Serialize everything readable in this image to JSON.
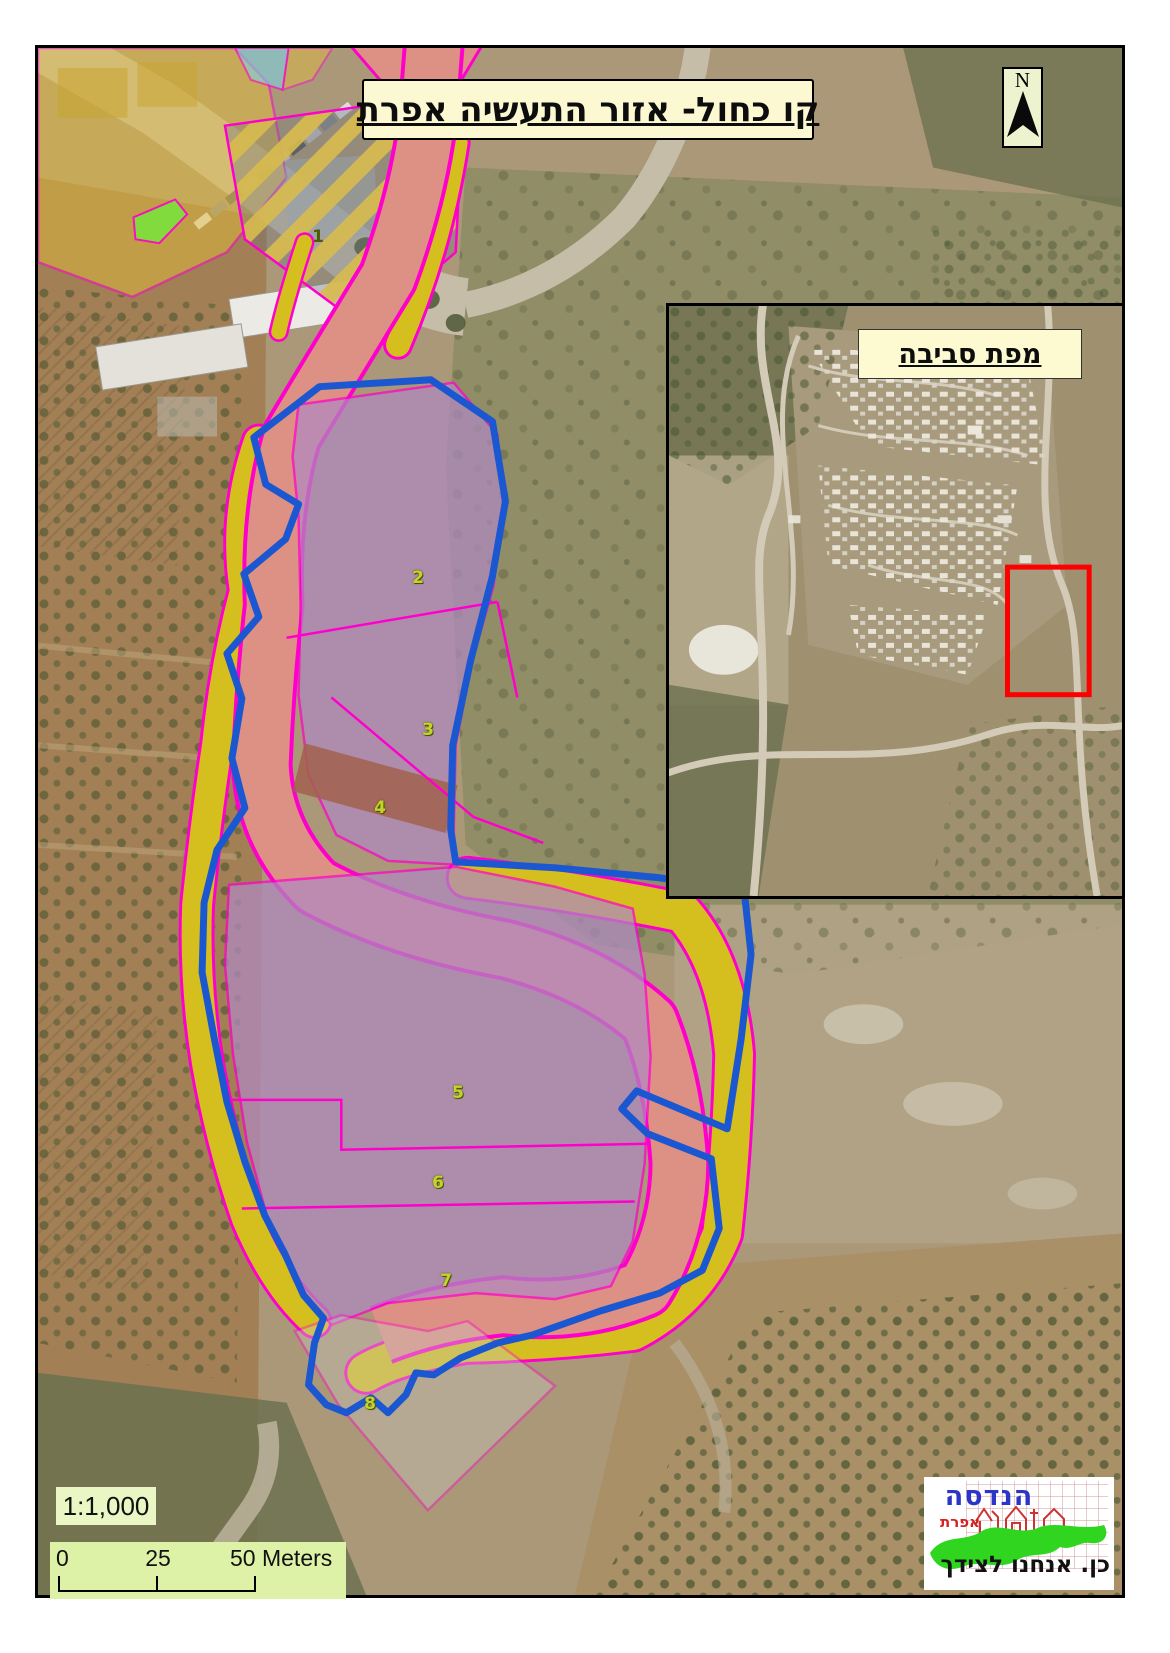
{
  "map": {
    "title": "קו כחול- אזור התעשיה אפרת",
    "north_label": "N",
    "scale_ratio": "1:1,000",
    "scalebar": {
      "tick0": "0",
      "tick1": "25",
      "tick2": "50 Meters"
    }
  },
  "inset": {
    "title": "מפת סביבה"
  },
  "parcel_labels": [
    {
      "num": "1"
    },
    {
      "num": "2"
    },
    {
      "num": "3"
    },
    {
      "num": "4"
    },
    {
      "num": "5"
    },
    {
      "num": "6"
    },
    {
      "num": "7"
    },
    {
      "num": "8"
    }
  ],
  "logo": {
    "name": "הנדסה",
    "subname": "אפרת",
    "tagline": "כן. אנחנו לצידך"
  },
  "colors": {
    "blue_line": "#1b57d0",
    "boundary_magenta": "#ff00cc",
    "industrial_purple": "#b08ac0",
    "road_salmon": "#dd9184",
    "green_strip": "#cde000",
    "overlay_yellow": "#e2bc3e",
    "highlight_red": "#fe0000"
  }
}
